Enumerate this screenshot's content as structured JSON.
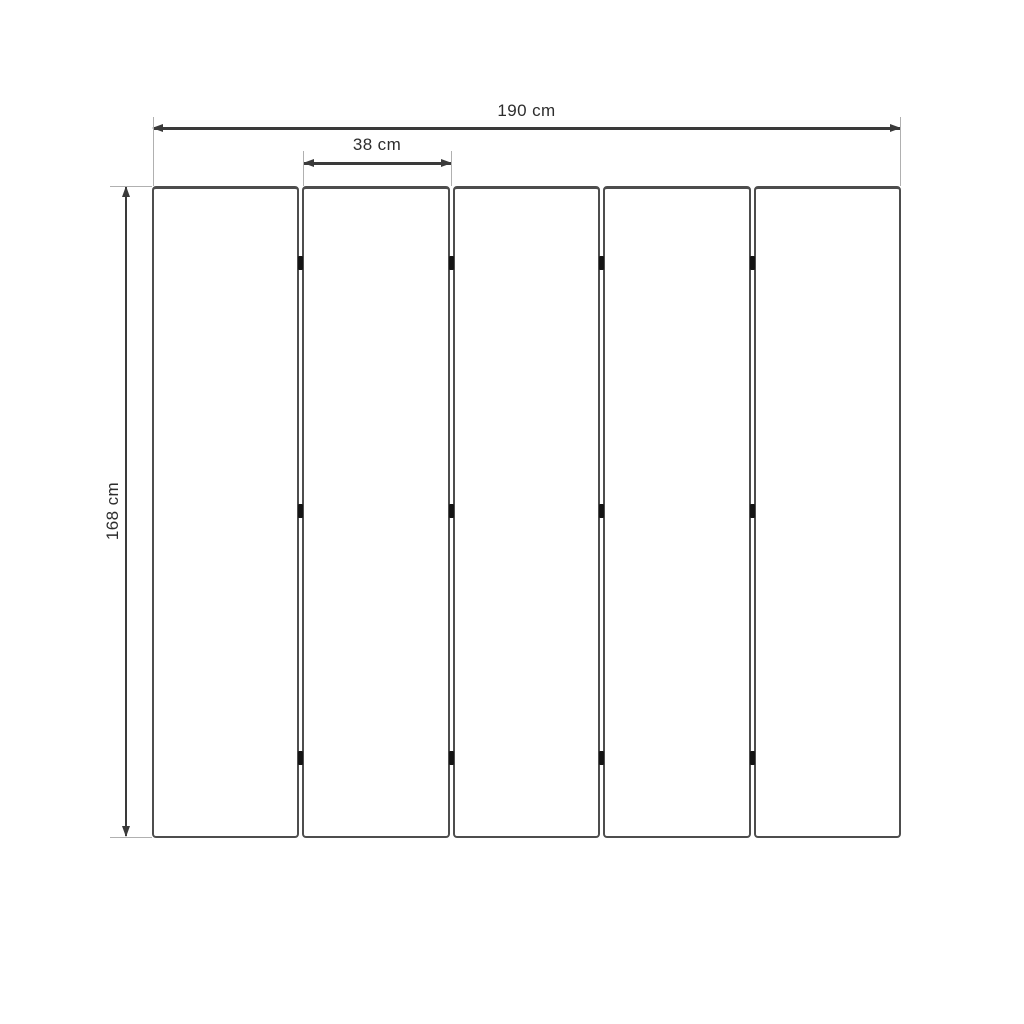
{
  "diagram": {
    "type": "dimension-diagram",
    "labels": {
      "total_width": "190 cm",
      "panel_width": "38 cm",
      "height": "168 cm"
    },
    "panels": {
      "count": 5
    },
    "hinges": {
      "per_gap": 3,
      "row_positions_pct": [
        11.8,
        49.8,
        87.7
      ]
    },
    "colors": {
      "dimension_line": "#3a3a3a",
      "extension_line": "#b0b0b0",
      "panel_border": "#4d4d4d",
      "panel_fill": "#ffffff",
      "hinge": "#141414",
      "text": "#2d2d2d",
      "background": "#ffffff"
    }
  }
}
